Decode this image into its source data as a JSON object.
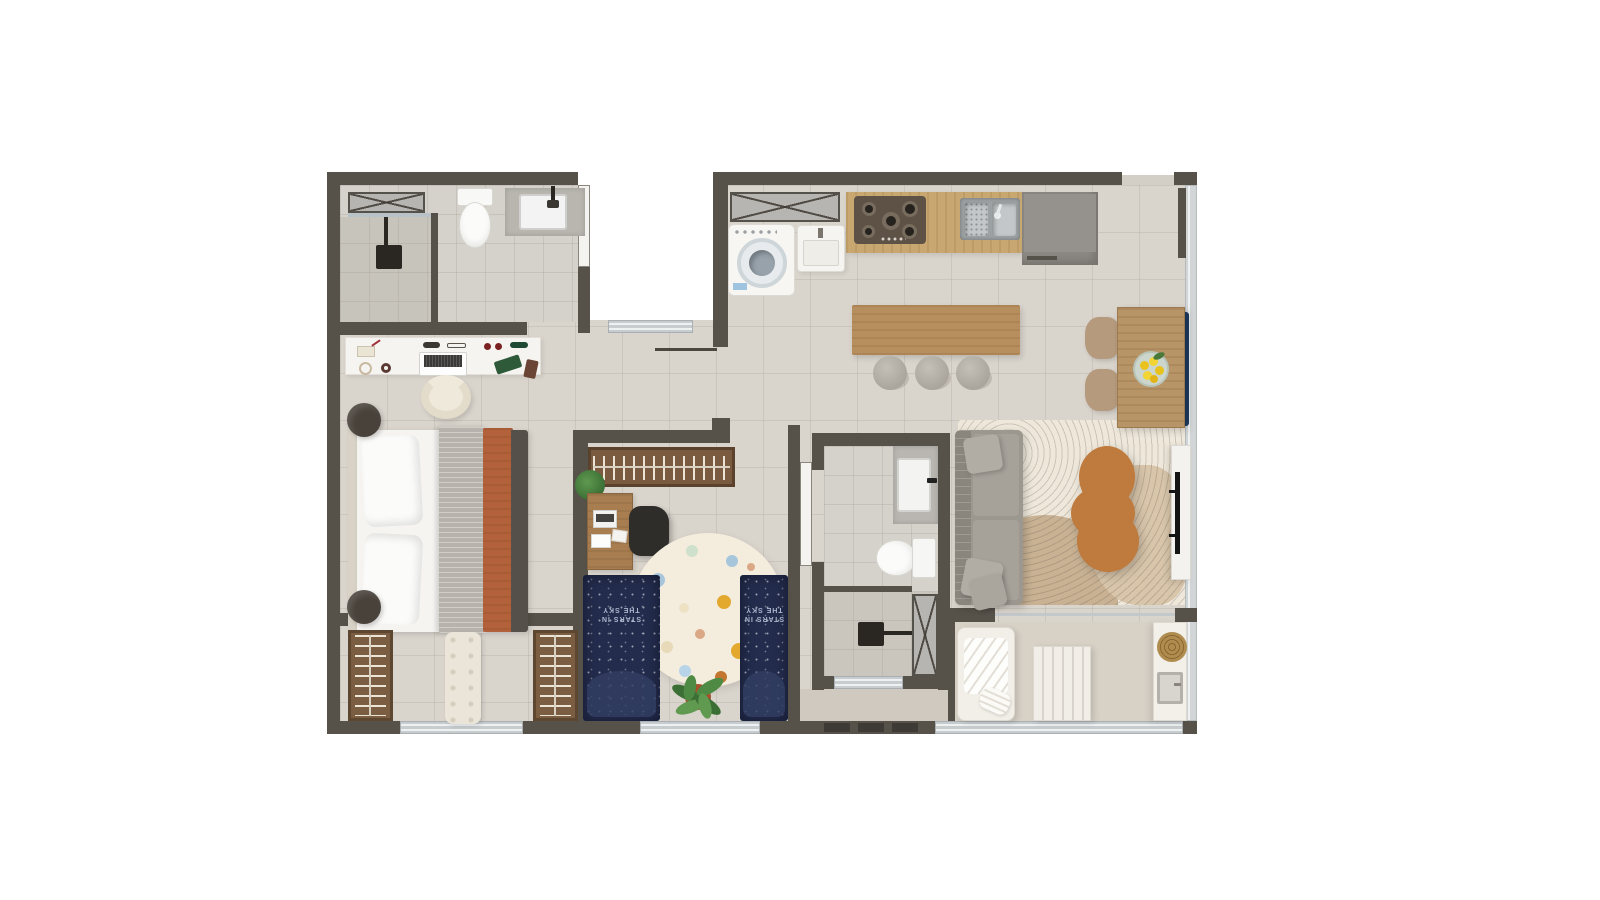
{
  "scene": {
    "type": "apartment-floor-plan-top-down-render",
    "background_color": "#ffffff",
    "visible_text": [
      "STARS IN THE SKY"
    ]
  },
  "labels": {
    "kids_blanket_text": "STARS IN THE SKY"
  },
  "palette": {
    "wall": "#56524a",
    "floor": "#d9d4cc",
    "bathroom_floor": "#d5d2cb",
    "counter_wood": "#c9a771",
    "island_wood": "#b78e5d",
    "wardrobe_wood": "#7b5d41",
    "sofa_gray": "#9c978f",
    "navy_textile": "#232c4d",
    "terracotta_blanket": "#b2613a",
    "blue_bench": "#1d3a60",
    "coffee_table_wood": "#bf7a3d",
    "window_glass": "#c7cccf",
    "kids_rug": "#f4edde",
    "living_rug": "#eee7da"
  },
  "rooms": [
    {
      "id": "bathroom-1",
      "label": "Bathroom 1",
      "furniture": [
        "service-shaft",
        "walk-in-shower",
        "toilet",
        "sink-counter"
      ]
    },
    {
      "id": "master-bedroom",
      "label": "Master Bedroom",
      "furniture": [
        "vanity-desk",
        "laptop",
        "vanity-chair",
        "double-bed",
        "pouf-nightstand",
        "pouf-nightstand"
      ]
    },
    {
      "id": "master-closet",
      "label": "Closet",
      "furniture": [
        "wardrobe",
        "tufted-bench",
        "wardrobe",
        "window"
      ]
    },
    {
      "id": "kids-bedroom",
      "label": "Kids Bedroom",
      "furniture": [
        "open-wardrobe",
        "desk",
        "desk-chair",
        "round-polkadot-rug",
        "single-bed",
        "single-bed",
        "potted-plant",
        "window"
      ]
    },
    {
      "id": "bathroom-2",
      "label": "Bathroom 2",
      "furniture": [
        "sink-counter",
        "toilet",
        "shower",
        "service-shaft",
        "window"
      ]
    },
    {
      "id": "kitchen-laundry",
      "label": "Kitchen / Laundry",
      "furniture": [
        "service-shaft",
        "washing-machine",
        "laundry-sink",
        "gas-cooktop",
        "double-kitchen-sink",
        "refrigerator-cabinet",
        "island-counter",
        "stool",
        "stool",
        "stool"
      ]
    },
    {
      "id": "dining",
      "label": "Dining",
      "furniture": [
        "dining-table",
        "lemon-bowl",
        "chair",
        "chair",
        "blue-tufted-bench",
        "entry-door"
      ]
    },
    {
      "id": "living-room",
      "label": "Living Room",
      "furniture": [
        "sofa",
        "throw-pillows",
        "area-rug",
        "organic-coffee-table",
        "tv-console",
        "tv"
      ]
    },
    {
      "id": "balcony",
      "label": "Balcony",
      "furniture": [
        "lounge-chair",
        "towel",
        "slatted-table",
        "counter",
        "woven-basket",
        "balcony-sink",
        "sliding-glass-door"
      ]
    },
    {
      "id": "service-ledge",
      "label": "Service Ledge",
      "furniture": [
        "vent-grates"
      ]
    }
  ]
}
